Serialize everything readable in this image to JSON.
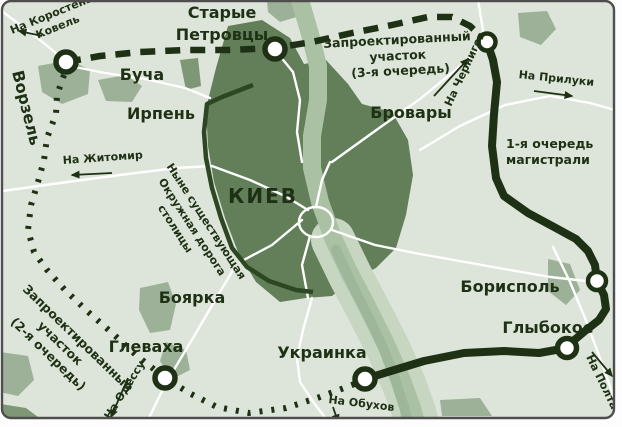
{
  "colors": {
    "background": "#dde4d9",
    "city_fill": "#627f5a",
    "suburb_fill": "#9cb197",
    "suburb_dark_fill": "#7e9775",
    "river_channel": "#aac1a3",
    "river_floodplain": "#c7d6c1",
    "river_streak": "#9eb79a",
    "road_white": "#ffffff",
    "route_dark": "#1e3115",
    "ring_road": "#2c4721",
    "frame": "#4e4e4e",
    "label": "#1e3115",
    "node_fill": "#ffffff"
  },
  "city": {
    "name": "КИЕВ"
  },
  "towns": {
    "starye_petrovtsy_line1": "Старые",
    "starye_petrovtsy_line2": "Петровцы",
    "bucha": "Буча",
    "irpen": "Ирпень",
    "vorzel": "Ворзель",
    "brovary": "Бровары",
    "borispol": "Борисполь",
    "glybokoe": "Глыбокое",
    "ukrainka": "Украинка",
    "glevakha": "Глеваха",
    "boyarka": "Боярка"
  },
  "directions": {
    "korosten_line1": "На Коростень,",
    "korosten_line2": "Ковель",
    "chernigov": "На Чернигов",
    "priluki": "На Прилуки",
    "zhitomir": "На Житомир",
    "odessa": "На Одессу",
    "obukhov": "На Обухов",
    "poltava": "На Полтаву"
  },
  "annotations": {
    "projected_3_line1": "Запроектированный",
    "projected_3_line2": "участок",
    "projected_3_line3": "(3-я очередь)",
    "first_stage_line1": "1-я очередь",
    "first_stage_line2": "магистрали",
    "projected_2_line1": "Запроектированный",
    "projected_2_line2": "участок",
    "projected_2_line3": "(2-я очередь)",
    "ring_road_line1": "Ныне существующая",
    "ring_road_line2": "Окружная дорога",
    "ring_road_line3": "столицы"
  }
}
